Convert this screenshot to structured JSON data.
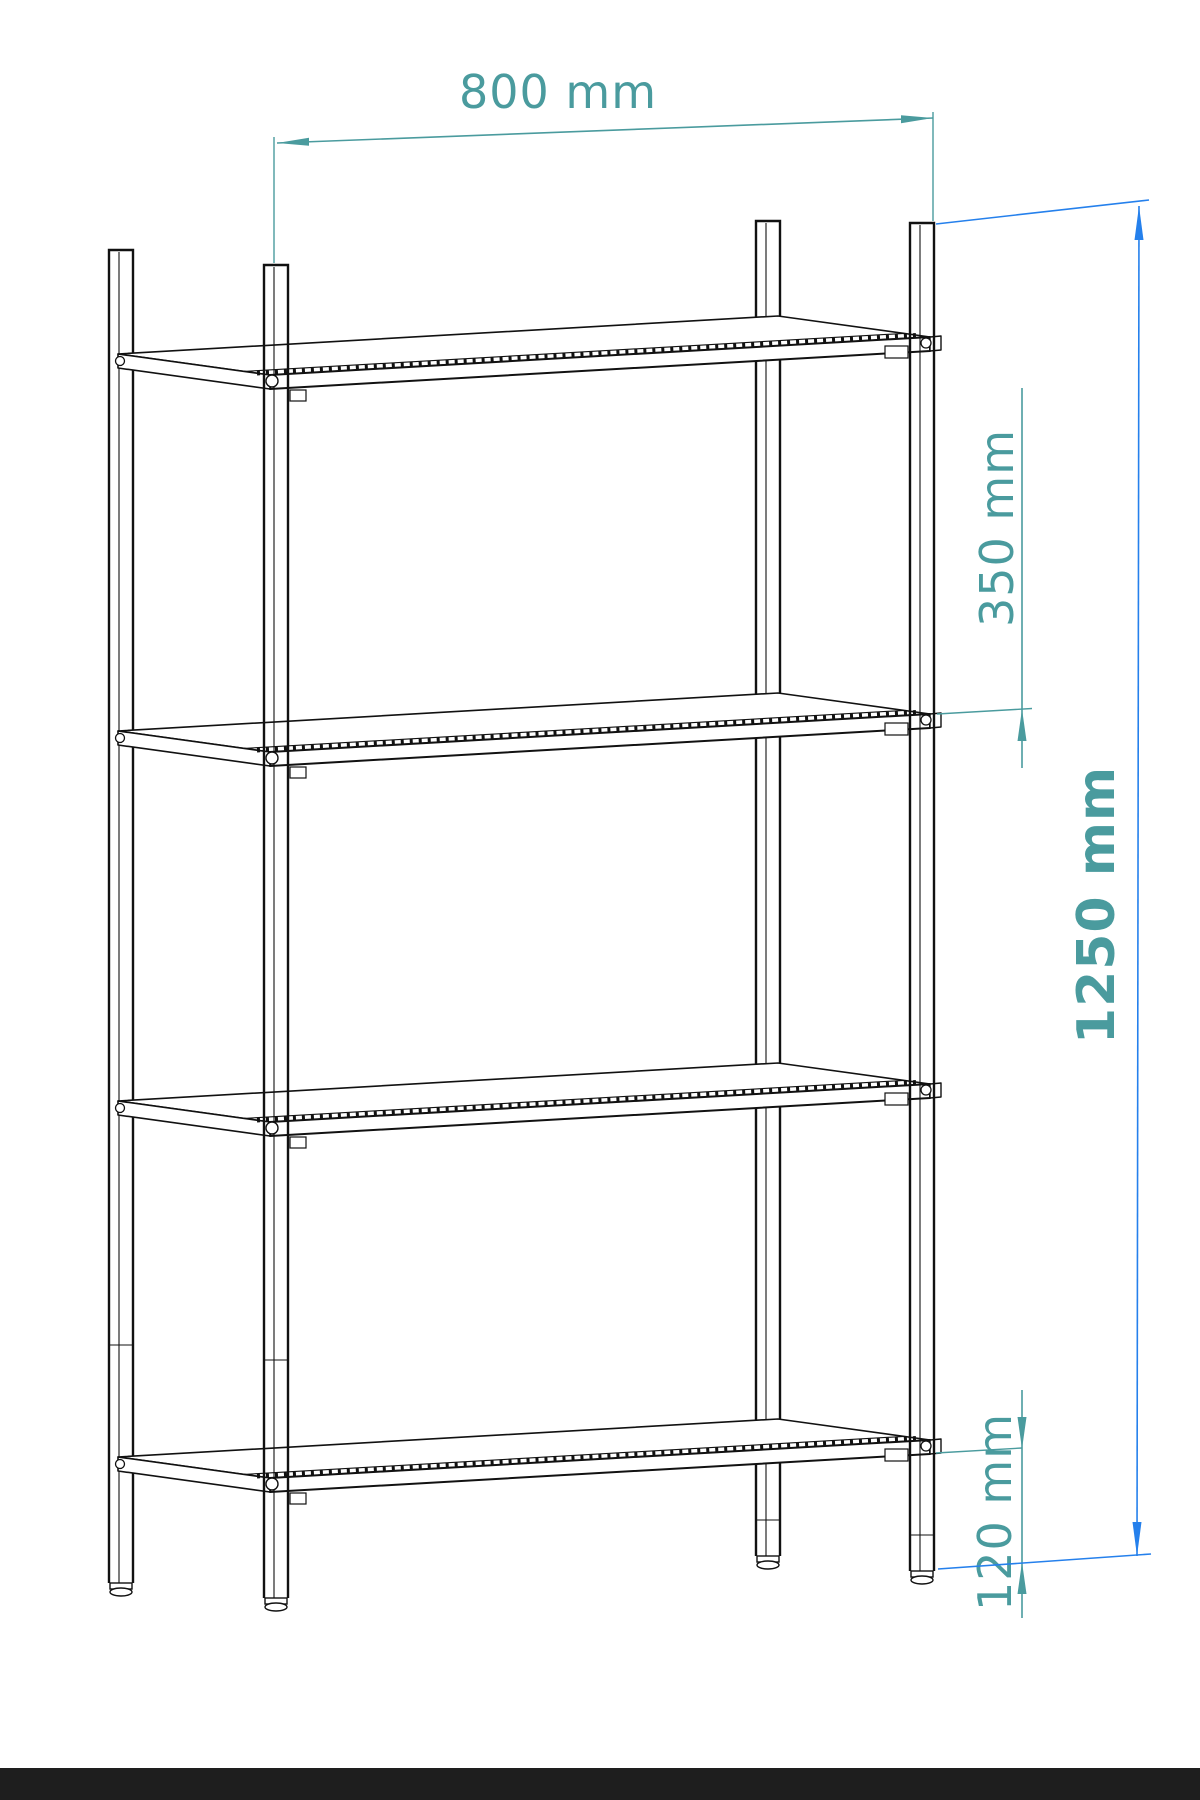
{
  "drawing": {
    "subject": "Dimensioned isometric line drawing of a 4-shelf open shelving rack with adjustable feet",
    "shelf_count": 4,
    "post_count": 4,
    "unit": "mm",
    "dimensions": {
      "width": {
        "label": "800 mm",
        "value": 800,
        "meaning": "overall shelf width between front posts"
      },
      "spacing": {
        "label": "350 mm",
        "value": 350,
        "meaning": "vertical spacing between shelf levels"
      },
      "height": {
        "label": "1250 mm",
        "value": 1250,
        "meaning": "overall height of the unit"
      },
      "clearance": {
        "label": "120 mm",
        "value": 120,
        "meaning": "bottom shelf height above floor"
      }
    },
    "colors": {
      "dimension_teal": "#4A9B9E",
      "dimension_blue": "#2580EC",
      "line_black": "#111111",
      "footer_bar": "#1E1E1E",
      "background": "#FFFFFF"
    }
  }
}
